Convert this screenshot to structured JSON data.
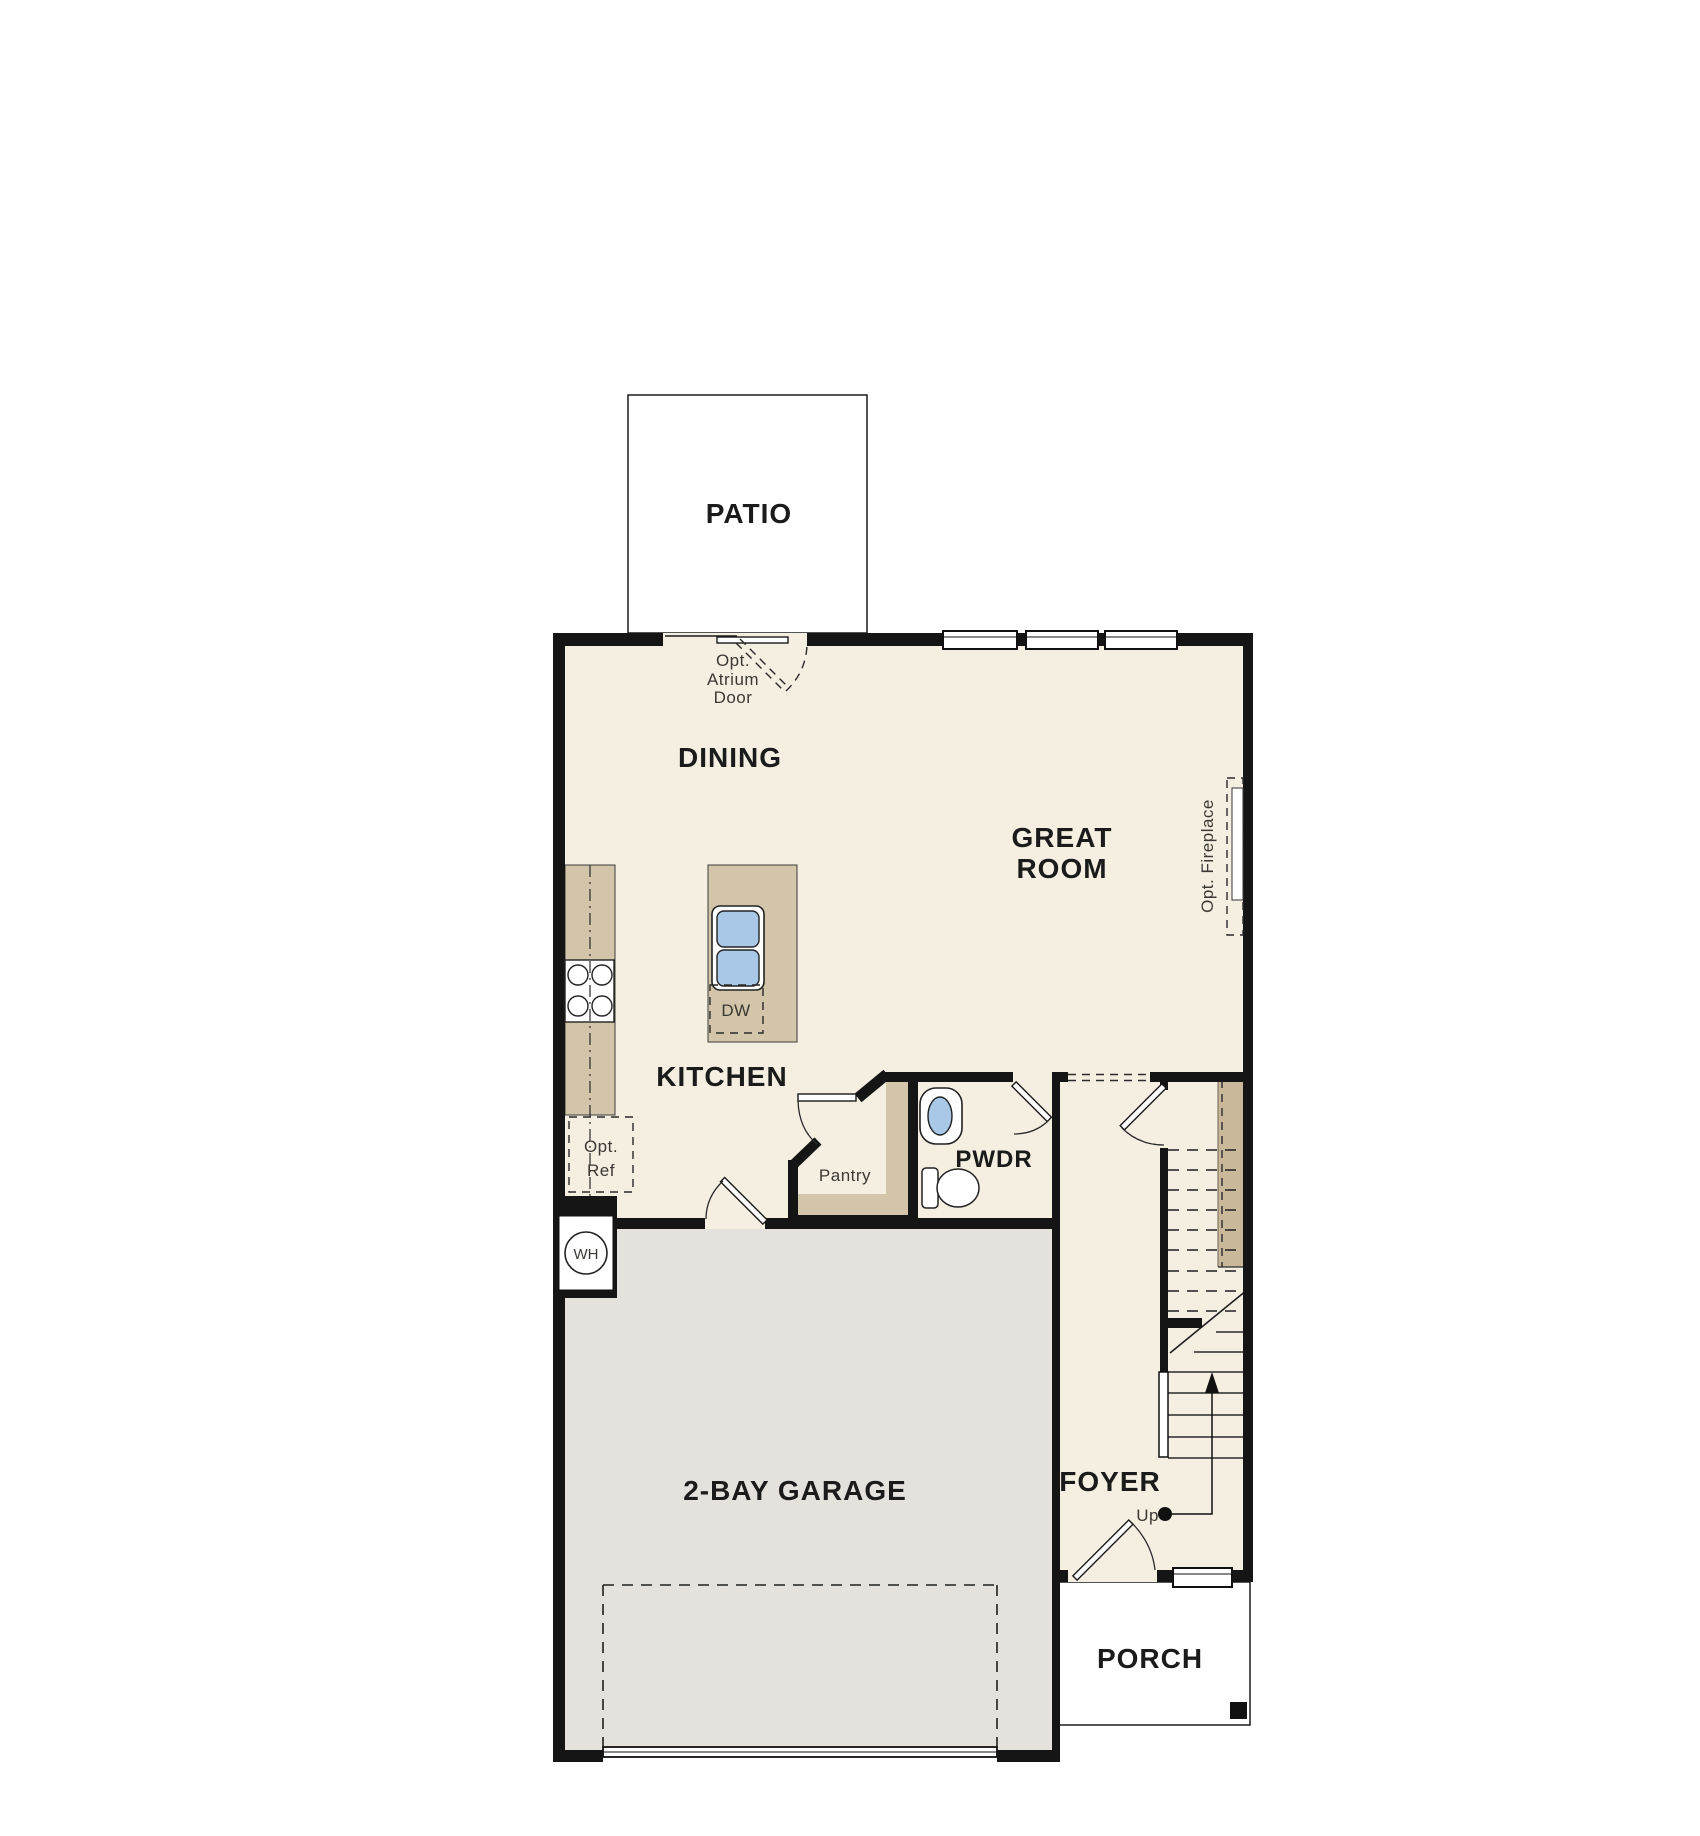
{
  "plan": {
    "rooms": {
      "patio": "PATIO",
      "dining": "DINING",
      "great_room": {
        "line1": "GREAT",
        "line2": "ROOM"
      },
      "kitchen": "KITCHEN",
      "pwdr": "PWDR",
      "pantry": "Pantry",
      "garage": "2-BAY GARAGE",
      "foyer": "FOYER",
      "porch": "PORCH"
    },
    "annotations": {
      "atrium": {
        "line1": "Opt.",
        "line2": "Atrium",
        "line3": "Door"
      },
      "opt_ref": {
        "line1": "Opt.",
        "line2": "Ref"
      },
      "dishwasher": "DW",
      "water_heater": "WH",
      "up": "Up",
      "opt_fireplace": "Opt. Fireplace"
    },
    "colors": {
      "floor": "#f5efe2",
      "exterior": "#e5e2de",
      "wall": "#151515",
      "cabinet": "#d2c5aa",
      "stair_band": "#c9b99a",
      "fixture_blue": "#a9c7e6",
      "appliance_gray": "#e0dcd6"
    }
  }
}
